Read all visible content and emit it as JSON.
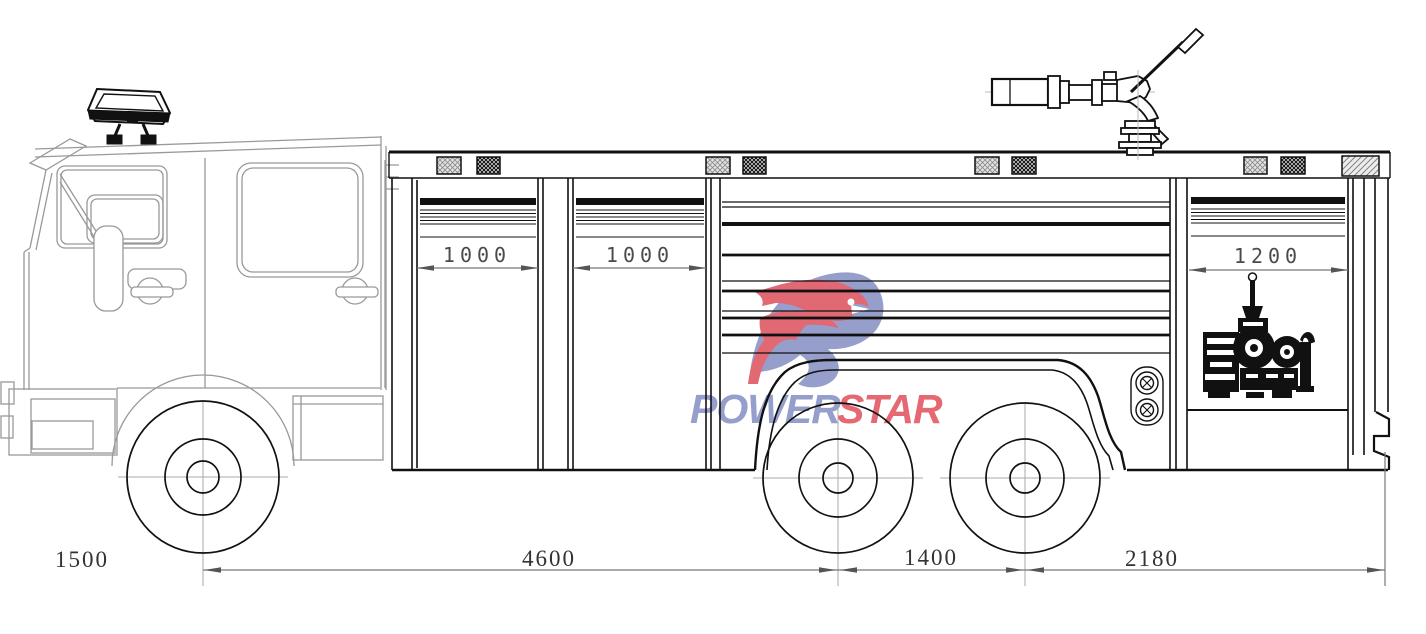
{
  "watermark": {
    "power": "POWER",
    "star": "STAR",
    "power_color": "#8892c4",
    "star_color": "#e25560"
  },
  "dimensions": {
    "compartment_left_width": "1000",
    "compartment_middle_width": "1000",
    "pump_bay_width": "1200",
    "front_overhang": "1500",
    "wheelbase": "4600",
    "tandem_axle_spacing": "1400",
    "rear_overhang": "2180"
  },
  "colors": {
    "line_art": "#111111",
    "cab_line": "#999999",
    "dimension_line": "#777777"
  }
}
